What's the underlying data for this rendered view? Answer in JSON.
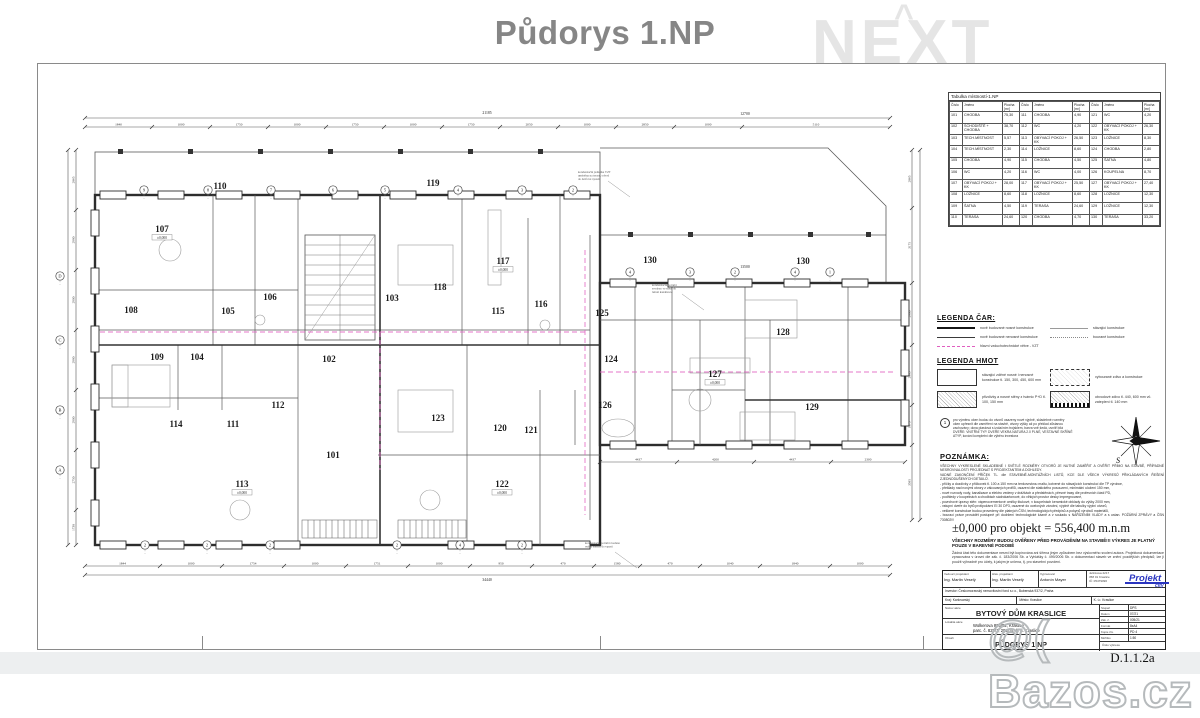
{
  "page": {
    "title": "Půdorys 1.NP"
  },
  "watermarks": {
    "next": "NEXT",
    "next_caret": "^",
    "bazos": "@( Bazos.cz"
  },
  "room_table": {
    "title": "Tabulka místností-1.NP",
    "header": [
      "Číslo",
      "Jméno",
      "Plocha [m²]"
    ],
    "rows": [
      [
        "101",
        "CHODBA",
        "75,30",
        "111",
        "CHODBA",
        "4,90",
        "121",
        "WC",
        "4,20"
      ],
      [
        "102",
        "SCHODIŠTĚ + CHODBA",
        "38,70",
        "112",
        "WC",
        "4,20",
        "122",
        "OBÝVACÍ POKOJ + KK",
        "26,30"
      ],
      [
        "103",
        "TECH.MÍSTNOST",
        "5,57",
        "113",
        "OBÝVACÍ POKOJ + KK",
        "26,50",
        "123",
        "LOŽNICE",
        "8,30"
      ],
      [
        "104",
        "TECH.MÍSTNOST",
        "2,30",
        "114",
        "LOŽNICE",
        "8,60",
        "124",
        "CHODBA",
        "2,80"
      ],
      [
        "105",
        "CHODBA",
        "4,90",
        "115",
        "CHODBA",
        "4,50",
        "125",
        "ŠATNA",
        "4,80"
      ],
      [
        "106",
        "WC",
        "4,20",
        "116",
        "WC",
        "4,00",
        "126",
        "KOUPELNA",
        "8,70"
      ],
      [
        "107",
        "OBÝVACÍ POKOJ + KK",
        "28,00",
        "117",
        "OBÝVACÍ POKOJ + KK",
        "25,50",
        "127",
        "OBÝVACÍ POKOJ + KK",
        "27,40"
      ],
      [
        "108",
        "LOŽNICE",
        "8,60",
        "118",
        "LOŽNICE",
        "8,60",
        "128",
        "LOŽNICE",
        "12,30"
      ],
      [
        "109",
        "ŠATNA",
        "4,50",
        "119",
        "TERASA",
        "24,60",
        "129",
        "LOŽNICE",
        "12,30"
      ],
      [
        "110",
        "TERASA",
        "24,60",
        "120",
        "CHODBA",
        "4,70",
        "130",
        "TERASA",
        "33,20"
      ]
    ]
  },
  "legend_car": {
    "title": "LEGENDA ČAR:",
    "left": [
      {
        "style": "ls-thick",
        "label": "nově budované nosné konstrukce"
      },
      {
        "style": "ls-med",
        "label": "nově budované nenosné konstrukce"
      },
      {
        "style": "ls-pink",
        "label": "hlavní vzduchotechnické větve - VZT"
      }
    ],
    "right": [
      {
        "style": "ls-thin",
        "label": "stávající konstrukce"
      },
      {
        "style": "ls-dot",
        "label": "bourané konstrukce"
      }
    ]
  },
  "legend_hmot": {
    "title": "LEGENDA HMOT",
    "left": [
      {
        "swatch": "",
        "label": "stávající zděné nosné i nenosné konstrukce tl. 150, 300, 450, 600 mm"
      },
      {
        "swatch": "sw-hatch",
        "label": "přizdívky a nosné stěny z tvárnic P+D tl. 100, 150 mm"
      }
    ],
    "right": [
      {
        "swatch": "sw-light",
        "label": "vybourané zdivo a konstrukce"
      },
      {
        "swatch": "sw-dark",
        "label": "obvodové zdivo tl. 440, 600 mm vč. zateplení tl. 140 mm"
      }
    ]
  },
  "circle_note": {
    "symbol": "1",
    "lines": [
      "pro výměnu oken budou do otvorů osazeny nové výplně, skladebné rozměry",
      "oken upřesnit dle zaměření na stavbě, otvory výšky až po překlad zůstanou",
      "zachovány; okna plastová s izolačním trojsklem, barva vně šedá, uvnitř bílá",
      "DVEŘE: VNITŘNÍ TYP. DVEŘE VEKRA NATURA 2.0 PLNÉ, VESTAVNÉ SKŘÍNĚ",
      "ATYP, kování kompletní dle výběru investora"
    ]
  },
  "compass": {
    "south_label": "S"
  },
  "note": {
    "title": "POZNÁMKA:",
    "lines": [
      "VŠECHNY VYKRESLENÉ SKLADEBNÉ I SVĚTLÉ ROZMĚRY OTVORŮ JE NUTNÉ ZAMĚŘIT A OVĚŘIT PŘÍMO NA STAVBĚ, PŘÍPADNÉ NESROVNALOSTI PROJEDNAT S PROJEKTANTEM A DOHLEDY.",
      "VADNÉ ZAKONČENÍ PŘÍČEK TL. dle STAVEBNĚ-MONTÁŽNÍCH LISTŮ, KCE DLE VŠECH VÝKRESŮ PŘIKLÁDANÝCH ŘEŠENÍ ZJEDNODUŠENÝCH DETAILŮ.",
      "- příčky a dozdívky z příčkovek tl. 100 a 150 mm na tenkovrstvou maltu, kotvené do stávajících konstrukcí dle TP výrobce,",
      "- překlady nad novými otvory z válcovaných profilů, osazení dle statického posouzení, minimální uložení 150 mm,",
      "- nové rozvody vody, kanalizace a elektro vedeny v drážkách a předstěnách, přesné trasy dle profesních částí PD,",
      "- podhledy v koupelnách a chodbách sádrokartonové, do vlhkých prostor desky impregnované,",
      "- povrchové úpravy stěn: vápenocementové omítky štukové, v koupelnách keramické obklady do výšky 2000 mm,",
      "- vstupní dveře do bytů protipožární EI 30 DP3, osazené do ocelových zárubní, výplně dle tabulky výplní otvorů,",
      "- veškeré konstrukce budou provedeny dle platných ČSN, technologických předpisů a pokynů výrobců materiálů,",
      "- bourací práce provádět postupně při dodržení technologické kázně a v souladu s NAŘÍZENÍM VLÁDY a s ustan. POŽÁRNÍ ZPRÁVY a ČSN 730802!!!"
    ]
  },
  "elevation": {
    "value": "±0,000 pro objekt = 556,400 m.n.m",
    "warning": "VŠECHNY ROZMĚRY BUDOU OVĚŘENY PŘED PROVÁDĚNÍM NA STAVBĚ!!! VÝKRES JE PLATNÝ POUZE V BAREVNÉ PODOBĚ",
    "copyright": "Žádná část této dokumentace nesmí být kopírována ani šířena jiným způsobem bez výslovného svolení autora. Projektová dokumentace zpracována v úrovni dle zák. č. 183/2006 Sb. a Vyhlášky č. 499/2006 Sb. o dokumentaci staveb ve znění pozdějších předpisů; lze ji použít výhradně pro účely, k jakým je určena, tj. pro stavební povolení."
  },
  "titleblock": {
    "roles": [
      {
        "label": "Vedoucí projektant",
        "value": "Ing. Martin Veselý"
      },
      {
        "label": "Hlav. projektant",
        "value": "Ing. Martin Veselý"
      },
      {
        "label": "Vypracoval",
        "value": "Antonín Mayer"
      }
    ],
    "office": {
      "address": [
        "Jelínkova 2217",
        "358 01 Kraslice",
        "IČ: 05479096"
      ],
      "logo1": "Projekt",
      "logo2": "city"
    },
    "investor": "Investor: Českomoravský nemovitostní fond s.r.o., Bubenská 937/2, Praha",
    "region": [
      {
        "label": "Kraj:",
        "value": "Karlovarský"
      },
      {
        "label": "Město:",
        "value": "Kraslice"
      },
      {
        "label": "K. ú.:",
        "value": "Kraslice"
      }
    ],
    "project_label": "Název akce",
    "project": "BYTOVÝ DŮM KRASLICE",
    "location_label": "Lokalita akce",
    "location1": "Wolkerova 895/52, Kraslice",
    "location2": "parc.   č. 828/1, 2937/4, k. ú. Kraslice",
    "content_label": "Obsah",
    "content": "PŮDORYS 1.NP",
    "drawing_no_label": "Číslo výkresu",
    "drawing_no": "D.1.1.2a",
    "meta": [
      {
        "label": "Stupeň",
        "value": "DPS"
      },
      {
        "label": "Datum",
        "value": "07/21"
      },
      {
        "label": "Zak. č.",
        "value": "005/21"
      },
      {
        "label": "Formát",
        "value": "8xA4"
      },
      {
        "label": "Kopie čís.",
        "value": "PD 4"
      },
      {
        "label": "Měřítko",
        "value": "1:50"
      }
    ]
  },
  "plan": {
    "rooms": [
      {
        "n": "110",
        "x": 220,
        "y": 189
      },
      {
        "n": "119",
        "x": 433,
        "y": 186
      },
      {
        "n": "107",
        "x": 162,
        "y": 232,
        "sub": "±0,000"
      },
      {
        "n": "117",
        "x": 503,
        "y": 264,
        "sub": "±0,000"
      },
      {
        "n": "130",
        "x": 650,
        "y": 263
      },
      {
        "n": "130",
        "x": 803,
        "y": 264
      },
      {
        "n": "118",
        "x": 440,
        "y": 290
      },
      {
        "n": "103",
        "x": 392,
        "y": 301
      },
      {
        "n": "106",
        "x": 270,
        "y": 300
      },
      {
        "n": "116",
        "x": 541,
        "y": 307
      },
      {
        "n": "108",
        "x": 131,
        "y": 313
      },
      {
        "n": "105",
        "x": 228,
        "y": 314
      },
      {
        "n": "115",
        "x": 498,
        "y": 314
      },
      {
        "n": "125",
        "x": 602,
        "y": 316
      },
      {
        "n": "128",
        "x": 783,
        "y": 335
      },
      {
        "n": "109",
        "x": 157,
        "y": 360
      },
      {
        "n": "104",
        "x": 197,
        "y": 360
      },
      {
        "n": "102",
        "x": 329,
        "y": 362
      },
      {
        "n": "124",
        "x": 611,
        "y": 362
      },
      {
        "n": "127",
        "x": 715,
        "y": 377,
        "sub": "±0,000"
      },
      {
        "n": "112",
        "x": 278,
        "y": 408
      },
      {
        "n": "126",
        "x": 605,
        "y": 408
      },
      {
        "n": "129",
        "x": 812,
        "y": 410
      },
      {
        "n": "123",
        "x": 438,
        "y": 421
      },
      {
        "n": "114",
        "x": 176,
        "y": 427
      },
      {
        "n": "111",
        "x": 233,
        "y": 427
      },
      {
        "n": "120",
        "x": 500,
        "y": 431
      },
      {
        "n": "121",
        "x": 531,
        "y": 433
      },
      {
        "n": "101",
        "x": 333,
        "y": 458
      },
      {
        "n": "113",
        "x": 242,
        "y": 487,
        "sub": "±0,000"
      },
      {
        "n": "122",
        "x": 502,
        "y": 487,
        "sub": "±0,000"
      }
    ],
    "grid_bubbles": {
      "top": [
        {
          "x": 144,
          "l": "9"
        },
        {
          "x": 208,
          "l": "8"
        },
        {
          "x": 271,
          "l": "7"
        },
        {
          "x": 333,
          "l": "6"
        },
        {
          "x": 385,
          "l": "5"
        },
        {
          "x": 458,
          "l": "4"
        },
        {
          "x": 522,
          "l": "3"
        },
        {
          "x": 573,
          "l": "2"
        }
      ],
      "top_right": [
        {
          "x": 630,
          "l": "4"
        },
        {
          "x": 690,
          "l": "3"
        },
        {
          "x": 735,
          "l": "2"
        },
        {
          "x": 795,
          "l": "4"
        },
        {
          "x": 830,
          "l": "1"
        }
      ],
      "bottom": [
        {
          "x": 145,
          "l": "2"
        },
        {
          "x": 207,
          "l": "2"
        },
        {
          "x": 270,
          "l": "2"
        },
        {
          "x": 397,
          "l": "2"
        },
        {
          "x": 460,
          "l": "4"
        },
        {
          "x": 522,
          "l": "2"
        }
      ],
      "left": [
        {
          "y": 276,
          "l": "D"
        },
        {
          "y": 340,
          "l": "C"
        },
        {
          "y": 410,
          "l": "B"
        },
        {
          "y": 470,
          "l": "A"
        }
      ]
    },
    "chains": [
      {
        "dir": "h",
        "y": 127,
        "ticks": [
          85,
          152,
          210,
          268,
          326,
          384,
          442,
          500,
          558,
          616,
          674,
          742,
          890
        ],
        "labels": [
          "1840",
          "1000",
          "1750",
          "1000",
          "1750",
          "1000",
          "1750",
          "2050",
          "1000",
          "2850",
          "1000",
          "5110"
        ]
      },
      {
        "dir": "h",
        "y": 118,
        "ticks": [
          85,
          890
        ],
        "labels": []
      },
      {
        "dir": "h",
        "y": 566,
        "ticks": [
          85,
          160,
          222,
          284,
          346,
          408,
          470,
          532,
          594,
          640,
          700,
          760,
          830,
          890
        ],
        "labels": [
          "1844",
          "1000",
          "1754",
          "1000",
          "1751",
          "1000",
          "950",
          "470",
          "1580",
          "470",
          "1040",
          "1840",
          "1000"
        ]
      },
      {
        "dir": "h",
        "y": 575,
        "ticks": [
          85,
          890
        ],
        "labels": []
      },
      {
        "dir": "h",
        "y": 462,
        "ticks": [
          600,
          677,
          754,
          831,
          905
        ],
        "labels": [
          "4437",
          "4200",
          "4437",
          "2300"
        ]
      },
      {
        "dir": "v",
        "x": 76,
        "ticks": [
          150,
          210,
          270,
          330,
          390,
          450,
          510,
          545
        ],
        "labels": [
          "2865",
          "2980",
          "2900",
          "2980",
          "2900",
          "2750",
          "1730"
        ]
      },
      {
        "dir": "v",
        "x": 68,
        "ticks": [
          150,
          545
        ],
        "labels": []
      },
      {
        "dir": "v",
        "x": 912,
        "ticks": [
          150,
          208,
          283,
          345,
          405,
          445,
          520
        ],
        "labels": [
          "2865",
          "3175",
          "2900",
          "2885",
          "1875",
          "3585"
        ]
      },
      {
        "dir": "v",
        "x": 920,
        "ticks": [
          150,
          520
        ],
        "labels": []
      }
    ],
    "totals": [
      {
        "x": 487,
        "y": 114,
        "t": "21185"
      },
      {
        "x": 745,
        "y": 115,
        "t": "12700"
      },
      {
        "x": 487,
        "y": 581,
        "t": "34440"
      },
      {
        "x": 745,
        "y": 268,
        "t": "13500"
      }
    ],
    "annotations": [
      {
        "x": 578,
        "y": 173,
        "lines": [
          "kondenzační jednotka VZT",
          "umístěna na terase, odvod",
          "do dešťové vpusti"
        ]
      },
      {
        "x": 652,
        "y": 286,
        "lines": [
          "kondenzační potrubí",
          "svedeno ve stěně do",
          "ležaté kanalizace"
        ]
      },
      {
        "x": 585,
        "y": 544,
        "lines": [
          "kondenzační potrubí svedeno",
          "vnější stěnou do vpusti"
        ]
      }
    ]
  }
}
